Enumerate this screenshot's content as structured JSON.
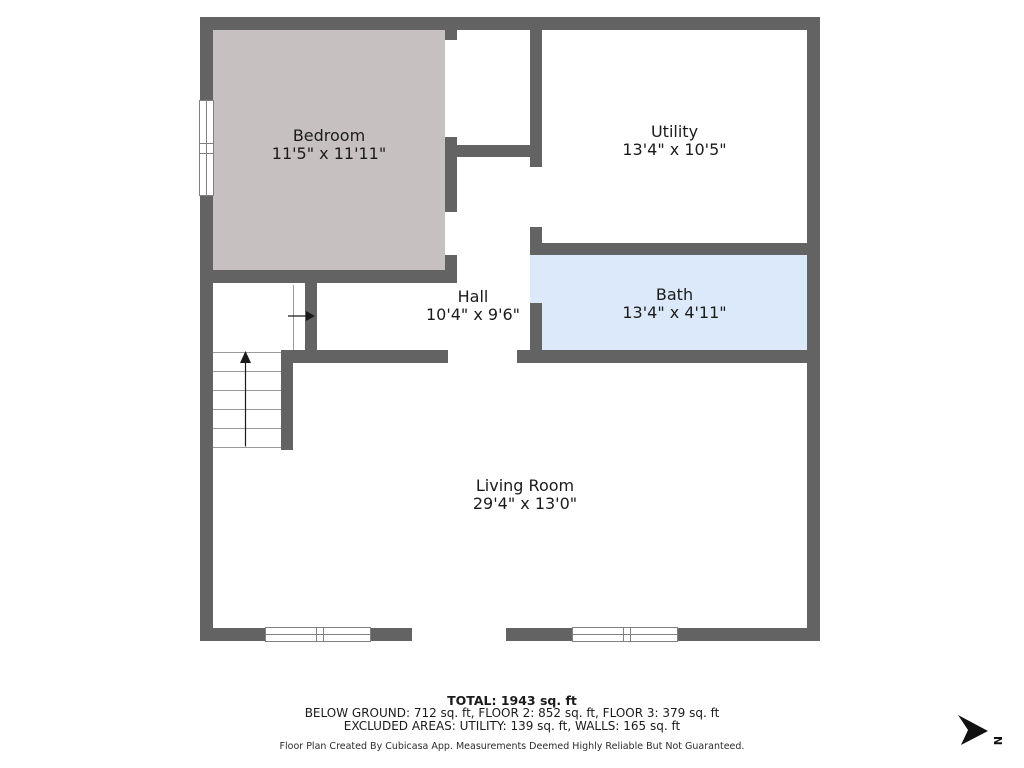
{
  "colors": {
    "wall": "#636363",
    "bedroom_fill": "#c6c1c0",
    "bath_fill": "#dbe9fa",
    "frame": "#808080",
    "line": "#9b9b9b",
    "text": "#1b1b1b",
    "arrow": "#1a1a1a",
    "compass": "#111111"
  },
  "rooms": {
    "bedroom": {
      "name": "Bedroom",
      "dims": "11'5\" x 11'11\""
    },
    "utility": {
      "name": "Utility",
      "dims": "13'4\" x 10'5\""
    },
    "hall": {
      "name": "Hall",
      "dims": "10'4\" x 9'6\""
    },
    "bath": {
      "name": "Bath",
      "dims": "13'4\" x 4'11\""
    },
    "living": {
      "name": "Living Room",
      "dims": "29'4\" x 13'0\""
    }
  },
  "summary": {
    "total": "TOTAL: 1943 sq. ft",
    "floors": "BELOW GROUND: 712 sq. ft, FLOOR 2: 852 sq. ft, FLOOR 3: 379 sq. ft",
    "excluded": "EXCLUDED AREAS: UTILITY: 139 sq. ft, WALLS: 165 sq. ft"
  },
  "footer": "Floor Plan Created By Cubicasa App. Measurements Deemed Highly Reliable But Not Guaranteed.",
  "compass": {
    "label": "N"
  }
}
